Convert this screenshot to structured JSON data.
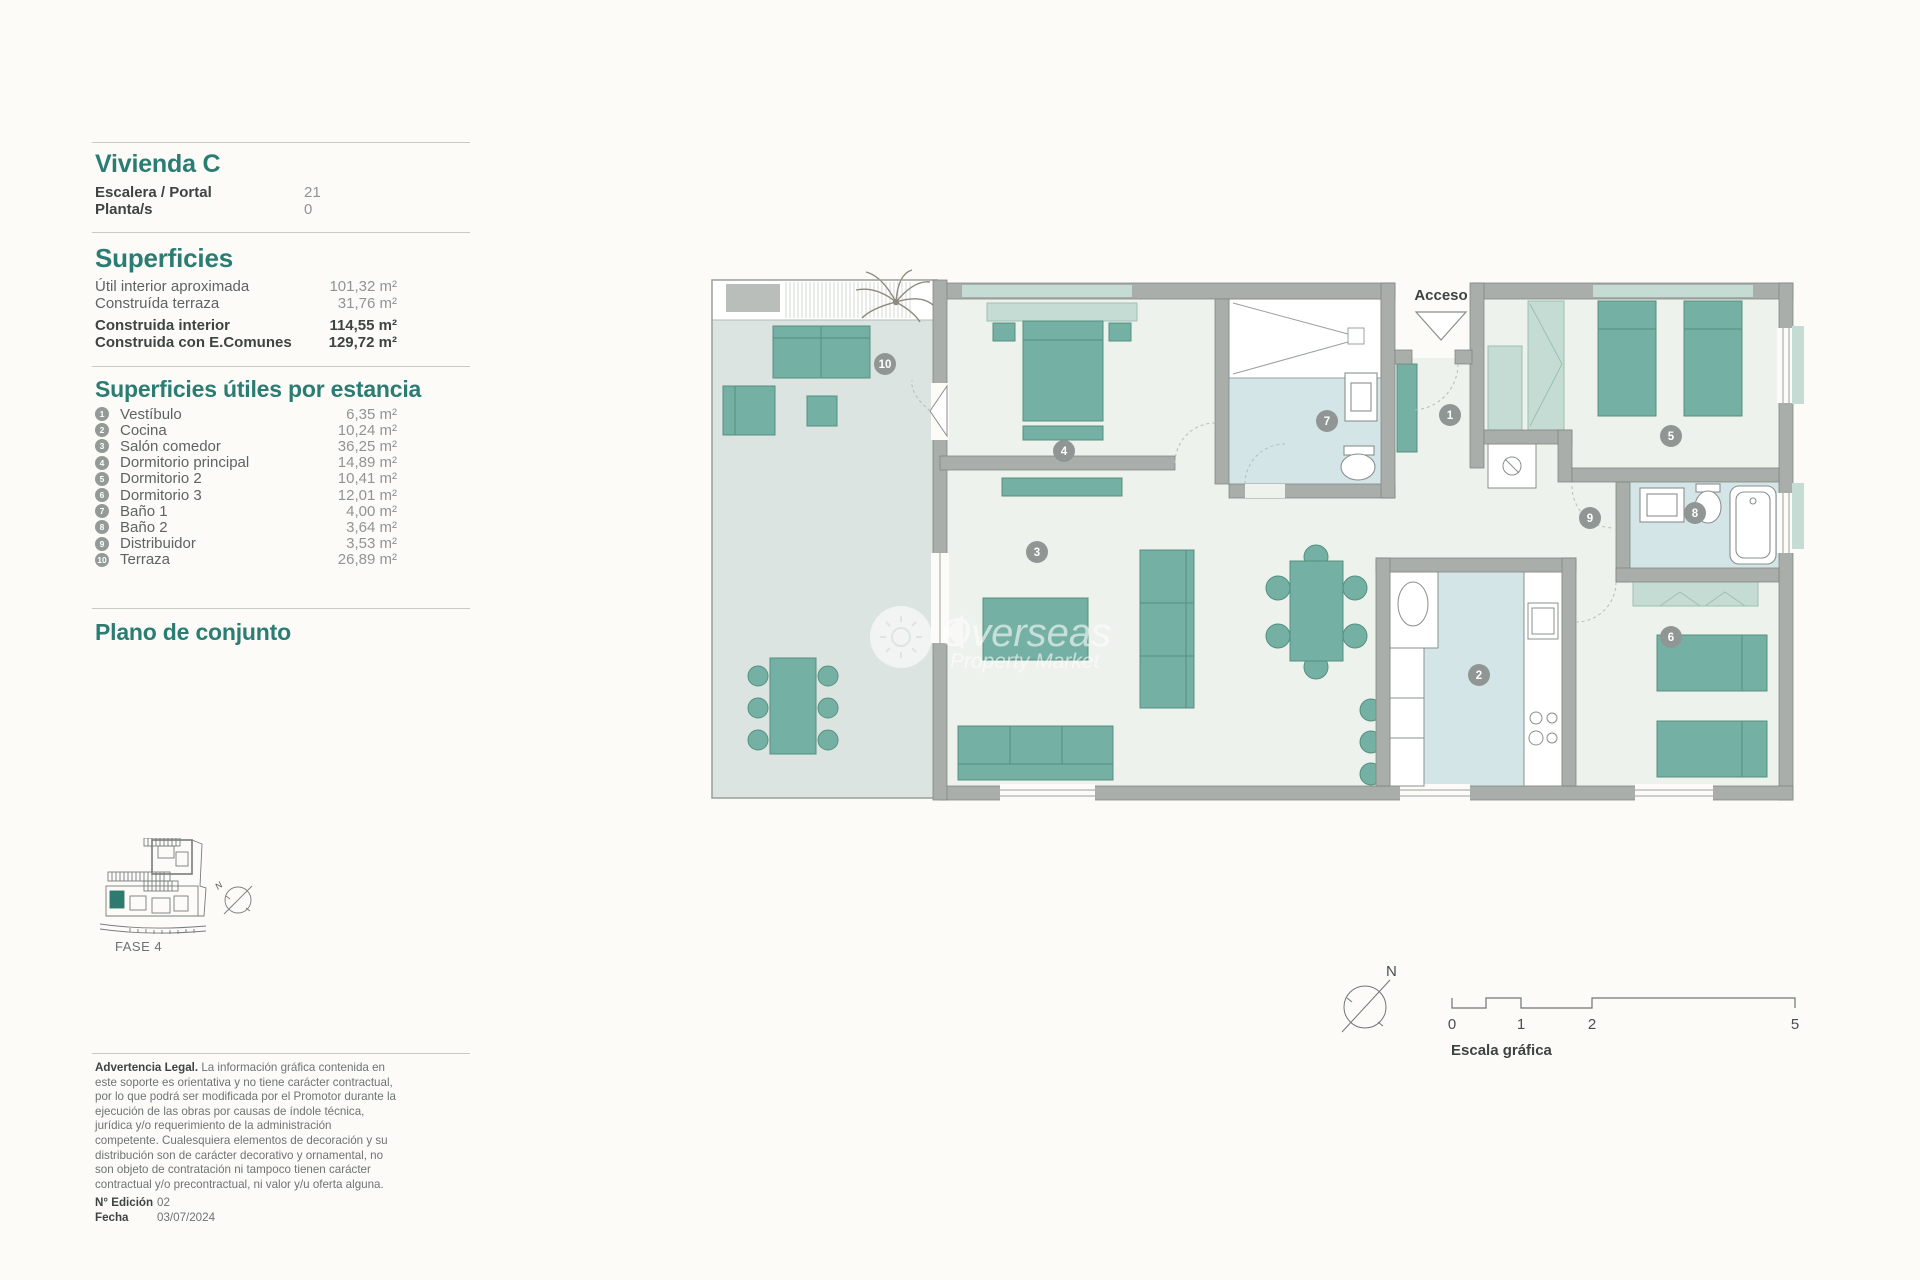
{
  "unit": {
    "title": "Vivienda C",
    "fields": [
      {
        "label": "Escalera / Portal",
        "value": "21"
      },
      {
        "label": "Planta/s",
        "value": "0"
      }
    ]
  },
  "superficies": {
    "title": "Superficies",
    "rows": [
      {
        "label": "Útil interior aproximada",
        "value": "101,32 m²"
      },
      {
        "label": "Construída terraza",
        "value": "31,76 m²"
      },
      {
        "label": "Construida interior",
        "value": "114,55 m²"
      },
      {
        "label": "Construida con E.Comunes",
        "value": "129,72 m²"
      }
    ]
  },
  "estancias": {
    "title": "Superficies útiles por estancia",
    "rooms": [
      {
        "num": "1",
        "label": "Vestíbulo",
        "area": "6,35 m²"
      },
      {
        "num": "2",
        "label": "Cocina",
        "area": "10,24 m²"
      },
      {
        "num": "3",
        "label": "Salón comedor",
        "area": "36,25 m²"
      },
      {
        "num": "4",
        "label": "Dormitorio principal",
        "area": "14,89 m²"
      },
      {
        "num": "5",
        "label": "Dormitorio 2",
        "area": "10,41 m²"
      },
      {
        "num": "6",
        "label": "Dormitorio 3",
        "area": "12,01 m²"
      },
      {
        "num": "7",
        "label": "Baño 1",
        "area": "4,00 m²"
      },
      {
        "num": "8",
        "label": "Baño 2",
        "area": "3,64 m²"
      },
      {
        "num": "9",
        "label": "Distribuidor",
        "area": "3,53 m²"
      },
      {
        "num": "10",
        "label": "Terraza",
        "area": "26,89 m²"
      }
    ]
  },
  "conjunto": {
    "title": "Plano de conjunto",
    "fase": "FASE 4"
  },
  "legal": {
    "heading": "Advertencia Legal.",
    "body": " La información gráfica contenida en este soporte es orientativa y no tiene carácter contractual, por lo que podrá ser modificada por el Promotor durante la ejecución de las obras por causas de índole técnica, jurídica y/o requerimiento de la administración competente. Cualesquiera elementos de decoración y su distribución son de carácter decorativo y ornamental, no son objeto de contratación ni tampoco tienen carácter contractual y/o precontractual, ni valor y/u oferta alguna.",
    "edition_label": "N° Edición",
    "edition_value": "02",
    "date_label": "Fecha",
    "date_value": "03/07/2024"
  },
  "plan": {
    "access_label": "Acceso",
    "watermark_line1": "Overseas",
    "watermark_line2": "Property Market"
  },
  "scalebar": {
    "label": "Escala gráfica",
    "ticks": [
      "0",
      "1",
      "2",
      "5"
    ],
    "north": "N"
  },
  "colors": {
    "accent_teal": "#2b7c73",
    "furniture_teal": "#74b0a3",
    "furniture_light": "#c5dcd4",
    "wall_gray": "#a9aeab",
    "interior_floor": "#eef2ec",
    "terrace_floor": "#dce4e1",
    "wet_floor": "#d4e5e8"
  }
}
